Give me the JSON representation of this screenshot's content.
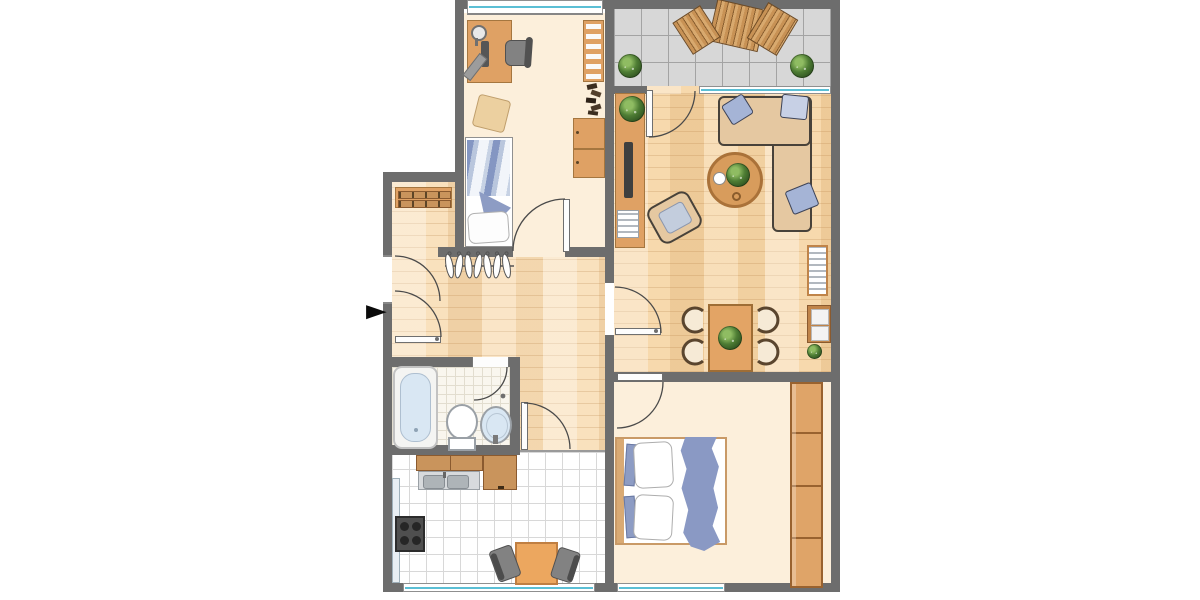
{
  "title": "apartment-floor-plan",
  "icons": {
    "entrance_arrow": "►"
  },
  "colors": {
    "wall": "#6d6d6d",
    "floor_cream": "#fcefdb",
    "wood_base": "#f7d9ad",
    "wood_hall": "#f9e1bd",
    "tile_line": "#d8d8d8",
    "bath_floor": "#f9f6ee",
    "bath_tile_line": "#e2ddcf",
    "balcony_floor": "#d7d7d7",
    "balcony_line": "#a3a3a3",
    "furn_orange": "#dfa164",
    "furn_orange_dark": "#a5763f",
    "counter_wood": "#c9945c",
    "counter_dark": "#8a5a2f",
    "sofa_tan": "#e5c8a1",
    "sofa_line": "#48423a",
    "pillow_blue": "#a5b4d6",
    "pillow_blue_light": "#c7d0e5",
    "bed_blue": "#8d9cc4",
    "blanket_blue": "#8a99c4",
    "stripe_blue": "#8496c2",
    "plant_dark": "#2f5220",
    "plant_mid": "#4e7d34",
    "plant_light": "#8fbc62",
    "steel": "#d7dadd",
    "steel_dark": "#aeb4b8",
    "fixture_blue": "#d9e7f3",
    "fixture_border": "#9aa0a6",
    "chair_gray": "#828282",
    "dark_appliance": "#4f4f4f",
    "window_teal": "#5bbfd5",
    "arc": "#4a4a4a",
    "arrow_black": "#0a0a0a"
  },
  "rooms": [
    {
      "id": "office",
      "furniture": [
        "desk",
        "desk-lamp",
        "monitor",
        "office-chair",
        "side-chair",
        "single-bed",
        "bookshelf",
        "books",
        "cabinet"
      ]
    },
    {
      "id": "balcony",
      "furniture": [
        "folding-table",
        "chair-left",
        "chair-right",
        "plant-left",
        "plant-right"
      ]
    },
    {
      "id": "living-dining",
      "furniture": [
        "sideboard",
        "tv",
        "plant",
        "magazine-rack",
        "corner-sofa",
        "3-pillows",
        "coffee-table",
        "plant-bouquet",
        "cup",
        "armchair",
        "radiator",
        "wall-shelf",
        "small-plant",
        "dining-table",
        "4-dining-chairs"
      ]
    },
    {
      "id": "hallway",
      "furniture": [
        "shoe-bench",
        "coat-rail",
        "7-hangers"
      ]
    },
    {
      "id": "bathroom",
      "furniture": [
        "bathtub",
        "toilet",
        "washbasin"
      ]
    },
    {
      "id": "kitchen",
      "furniture": [
        "counter-run",
        "double-sink",
        "corner-cabinet",
        "tall-cabinet",
        "stove",
        "table",
        "2-chairs"
      ]
    },
    {
      "id": "bedroom",
      "furniture": [
        "double-bed",
        "2-pillows",
        "2-cushions",
        "blanket",
        "wardrobe-4-doors"
      ]
    }
  ],
  "doors": [
    "entrance",
    "office",
    "bathroom",
    "kitchen",
    "living",
    "bedroom",
    "balcony"
  ],
  "windows": [
    "office-top",
    "living-balcony",
    "kitchen-bottom",
    "bedroom-bottom"
  ]
}
